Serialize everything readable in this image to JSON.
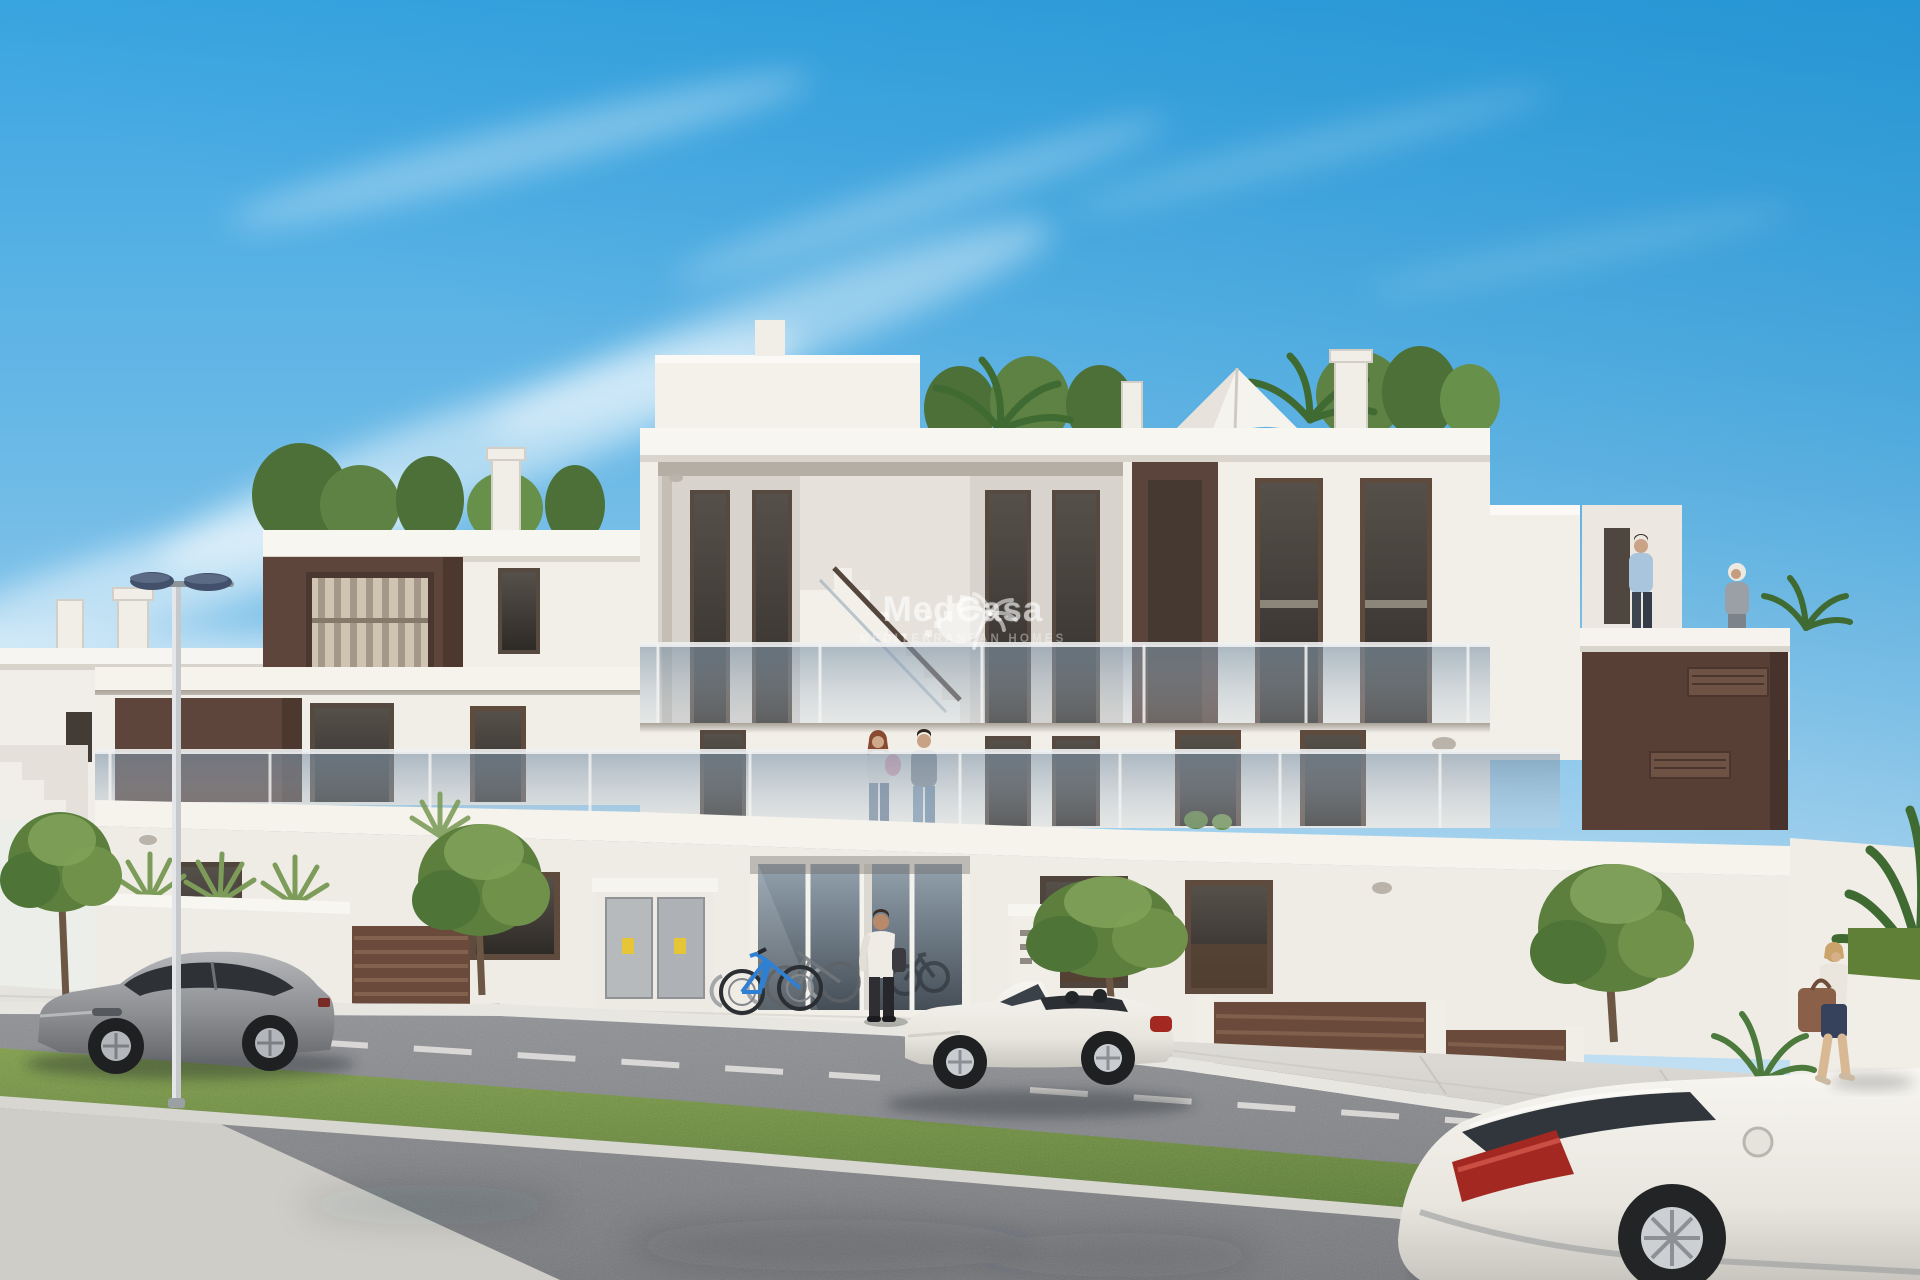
{
  "image": {
    "kind": "architectural_render",
    "description": "Sunny 3D exterior render of a modern white Mediterranean apartment building with rooftop terraces and plants, a patio umbrella, brown accent panels, long glass balconies, street-level entrance with utility cabinets and bicycles, a double street lamp, three parked cars (grey coupe, white convertible, white coupe), a couple with a baby on the balcony, a man at the entrance, two people on the right roof terrace and a woman walking with a bag"
  },
  "watermark": {
    "brand": "MedCasa",
    "tagline": "MEDITERRANEAN HOMES",
    "logo_icon": "sun-palm-logo"
  },
  "inventory": {
    "cars": 3,
    "bicycles": 2,
    "people": 6,
    "street_lamps": 1,
    "patio_umbrellas": 1
  },
  "palette": {
    "sky_deep": "#2f9fde",
    "sky_pale": "#dcecf7",
    "facade": "#f2efe9",
    "facade_shade": "#d9d4cc",
    "accent_brown": "#5d453b",
    "window_glass": "#38332e",
    "glass_balustrade": "#8ea3b4",
    "greenery": "#5d7f3e",
    "grass": "#6f9040",
    "road": "#84868a",
    "sidewalk": "#d8d6d1",
    "car_silver": "#9fa1a4",
    "car_white": "#f0eee8",
    "taillight_red": "#a32822",
    "bicycle_blue": "#2f7fd2",
    "lamp_head": "#42506b",
    "sticker_yellow": "#e6c637"
  }
}
